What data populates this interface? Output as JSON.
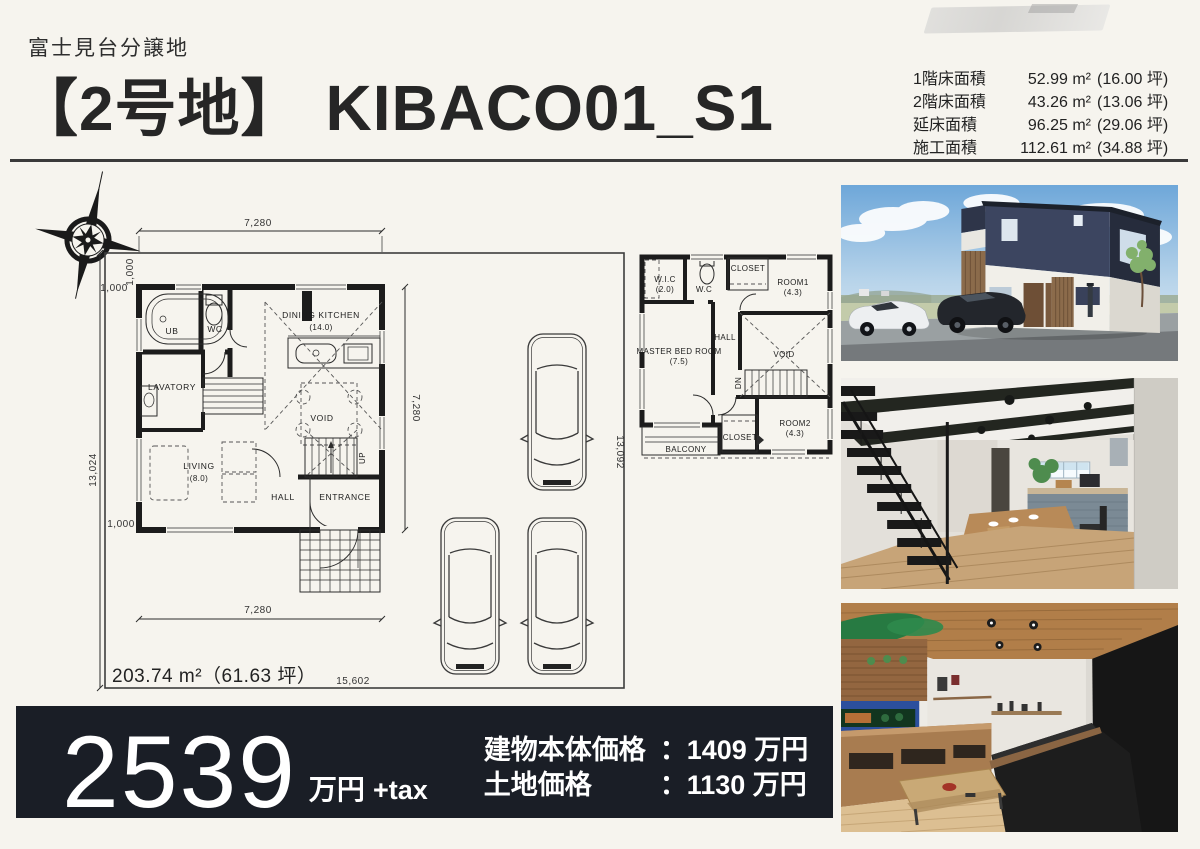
{
  "header": {
    "subtitle": "富士見台分譲地",
    "title_bracket": "【2号地】",
    "title_model": "KIBACO01_S1"
  },
  "area_table": {
    "rows": [
      {
        "label": "1階床面積",
        "sqm": "52.99 m²",
        "tsubo": "(16.00 坪)"
      },
      {
        "label": "2階床面積",
        "sqm": "43.26 m²",
        "tsubo": "(13.06 坪)"
      },
      {
        "label": "延床面積",
        "sqm": "96.25 m²",
        "tsubo": "(29.06 坪)"
      },
      {
        "label": "施工面積",
        "sqm": "112.61 m²",
        "tsubo": "(34.88 坪)"
      }
    ]
  },
  "site_plan": {
    "area_text": "203.74 m²（61.63 坪）",
    "dims": {
      "top": "7,280",
      "offset_top_h": "1,000",
      "offset_top_v": "1,000",
      "left": "13,024",
      "right": "7,280",
      "offset_bottom": "1,000",
      "bottom": "7,280",
      "site_bottom": "15,602",
      "site_right": "13,092"
    },
    "rooms": {
      "ub": "UB",
      "wc": "WC",
      "lavatory": "LAVATORY",
      "dining_kitchen": "DINING KITCHEN",
      "dining_kitchen_size": "(14.0)",
      "void": "VOID",
      "living": "LIVING",
      "living_size": "(8.0)",
      "hall": "HALL",
      "entrance": "ENTRANCE",
      "up": "UP"
    }
  },
  "floor2": {
    "rooms": {
      "wic": "W.I.C",
      "wic_size": "(2.0)",
      "wc": "W.C",
      "closet_top": "CLOSET",
      "room1": "ROOM1",
      "room1_size": "(4.3)",
      "hall": "HALL",
      "master": "MASTER BED ROOM",
      "master_size": "(7.5)",
      "void": "VOID",
      "dn": "DN",
      "room2": "ROOM2",
      "room2_size": "(4.3)",
      "closet_bottom": "CLOSET",
      "balcony": "BALCONY"
    }
  },
  "price": {
    "amount": "2539",
    "unit": "万円",
    "tax": "+tax",
    "colon": "：",
    "building_label": "建物本体価格",
    "building_value": "1409 万円",
    "land_label": "土地価格",
    "land_value": "1130 万円"
  }
}
